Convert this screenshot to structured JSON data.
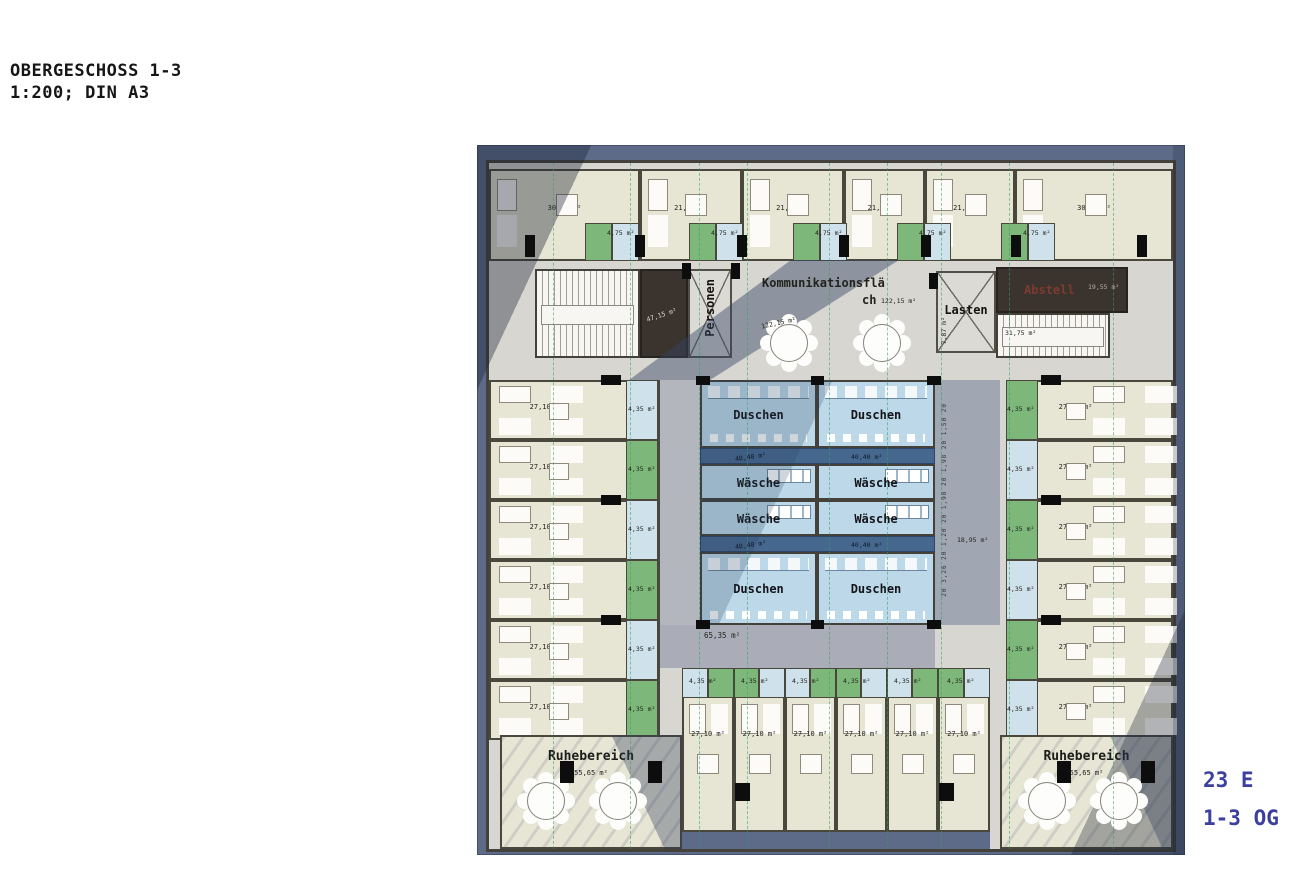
{
  "header": {
    "title_line1": "OBERGESCHOSS 1-3",
    "title_line2": "1:200; DIN A3"
  },
  "stamp": {
    "units": "23 E",
    "floors": "1-3 OG"
  },
  "plan": {
    "top_rooms": [
      "30,50 m²",
      "21,55 m²",
      "21,55 m²",
      "21,55 m²",
      "21,05 m²",
      "30,50 m²"
    ],
    "top_bath_area": "4,75 m²",
    "core": {
      "stair_left_area": "47,15 m²",
      "personen_label": "Personen",
      "komm_title": "Kommunikationsflä",
      "komm_title_cont": "ch",
      "komm_area": "122,15 m²",
      "komm_area_floor": "122,15 m²",
      "lasten_label": "Lasten",
      "lasten_area": "7,87 m²",
      "abstell_label": "Abstell",
      "abstell_area": "19,55 m²",
      "stair_right_area": "31,75 m²"
    },
    "left_rooms": [
      "27,10 m²",
      "27,10 m²",
      "27,10 m²",
      "27,10 m²",
      "27,10 m²",
      "27,10 m²"
    ],
    "left_bath_area": "4,35 m²",
    "right_rooms": [
      "27,50 m²",
      "27,50 m²",
      "27,50 m²",
      "27,50 m²",
      "27,50 m²",
      "27,50 m²"
    ],
    "right_bath_area": "4,35 m²",
    "sanitary": {
      "duschen": "Duschen",
      "waesche": "Wäsche",
      "area": "40,40 m²"
    },
    "corridors": {
      "south_area": "65,35 m²",
      "east_area": "18,95 m²",
      "east_dims": "20 3,26 20 1,20 20 1,98 20 1,98 20 1,50 20"
    },
    "bottom_rooms": [
      "27,10 m²",
      "27,10 m²",
      "27,10 m²",
      "27,10 m²",
      "27,10 m²",
      "27,10 m²"
    ],
    "bottom_bath_area": "4,35 m²",
    "ruhe_left": {
      "label": "Ruhebereich",
      "area": "55,65 m²"
    },
    "ruhe_right": {
      "label": "Ruhebereich",
      "area": "55,65 m²"
    }
  },
  "colors": {
    "stamp_blue": "#3b3f9e",
    "facade_slate": "#5d6b89",
    "room_beige": "#e7e5d4",
    "bath_green": "#7db87a",
    "bath_blue": "#cfe2ec",
    "sanitary_blue": "#bdd8e8",
    "navy_strip": "#46688f"
  }
}
